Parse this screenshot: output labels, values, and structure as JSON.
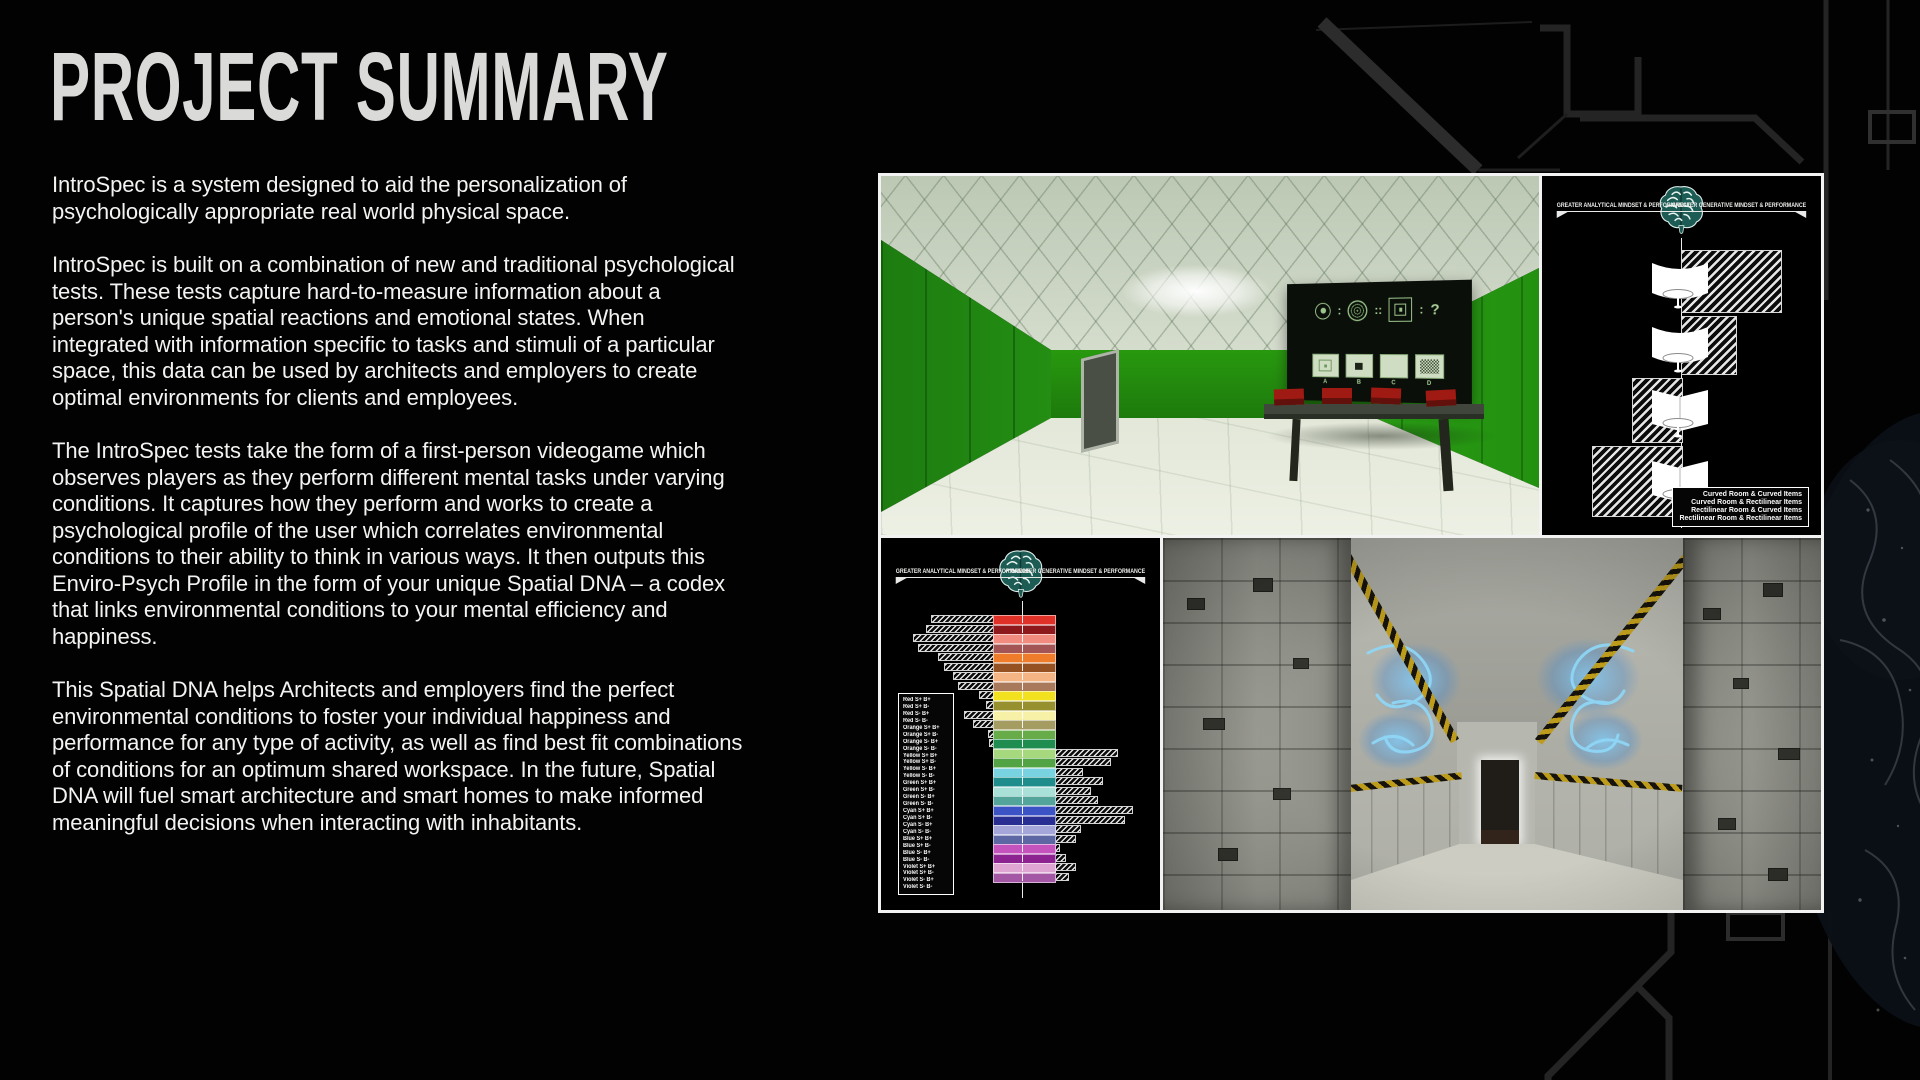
{
  "palette": {
    "background": "#020202",
    "text": "#f3f3f1",
    "panel_border": "#f2f2f2",
    "chroma_green": "#2aa216",
    "brain_teal": "#1d5b55",
    "hazard_yellow": "#bd9c1c",
    "glow_blue": "#78c8fa",
    "hatch_white": "#e6e6e6"
  },
  "header": {
    "title": "PROJECT SUMMARY"
  },
  "summary": {
    "paragraphs": [
      "IntroSpec is a system designed to aid the personalization of psychologically appropriate real world physical space.",
      "IntroSpec is built on a combination of new and traditional psychological tests. These tests capture hard-to-measure information about a person's unique spatial reactions and emotional states. When integrated with information specific to tasks and stimuli of a particular space, this data can be used by architects and employers to create optimal environments for clients and employees.",
      "The IntroSpec tests take the form of a first-person videogame which observes players as they perform different mental tasks under varying conditions. It captures how they perform and works to create a psychological profile of the user which correlates environmental conditions to their ability to think in various ways. It then outputs this Enviro-Psych Profile in the form of your unique Spatial DNA – a codex that links environmental conditions to your mental efficiency and happiness.",
      "This Spatial DNA helps Architects and employers find the perfect environmental conditions to foster your individual happiness and performance for any type of activity, as well as find best fit combinations of conditions for an optimum shared workspace. In the future, Spatial DNA will fuel smart architecture and smart homes to make informed meaningful decisions when interacting with inhabitants."
    ]
  },
  "mindset_axis": {
    "left_label": "GREATER ANALYTICAL MINDSET & PERFORMANCE",
    "right_label": "GREATER GENERATIVE MINDSET & PERFORMANCE"
  },
  "room_preference_diagram": {
    "rows": [
      {
        "room": "curved",
        "items": "curved",
        "side": "right",
        "length": 99
      },
      {
        "room": "curved",
        "items": "rectilinear",
        "side": "right",
        "length": 54
      },
      {
        "room": "rectilinear",
        "items": "curved",
        "side": "left",
        "length": 49
      },
      {
        "room": "rectilinear",
        "items": "rectilinear",
        "side": "left",
        "length": 89
      }
    ],
    "legend": [
      "Curved Room & Curved Items",
      "Curved Room & Rectilinear Items",
      "Rectilinear Room & Curved Items",
      "Rectilinear Room & Rectilinear Items"
    ]
  },
  "green_room_puzzle": {
    "separator_single": ":",
    "separator_double": "::",
    "question_mark": "?",
    "options": [
      "A",
      "B",
      "C",
      "D"
    ]
  },
  "chart_data": {
    "type": "bar",
    "orientation": "diverging-horizontal",
    "axis_left_label": "GREATER ANALYTICAL MINDSET & PERFORMANCE",
    "axis_right_label": "GREATER GENERATIVE MINDSET & PERFORMANCE",
    "xlim": [
      -100,
      100
    ],
    "grid": false,
    "legend_position": "left",
    "categories": [
      "Red S+ B+",
      "Red S+ B-",
      "Red S- B+",
      "Red S- B-",
      "Orange S+ B+",
      "Orange S+ B-",
      "Orange S- B+",
      "Orange S- B-",
      "Yellow S+ B+",
      "Yellow S+ B-",
      "Yellow S- B+",
      "Yellow S- B-",
      "Green S+ B+",
      "Green S+ B-",
      "Green S- B+",
      "Green S- B-",
      "Cyan S+ B+",
      "Cyan S+ B-",
      "Cyan S- B+",
      "Cyan S- B-",
      "Blue S+ B+",
      "Blue S+ B-",
      "Blue S- B+",
      "Blue S- B-",
      "Violet S+ B+",
      "Violet S+ B-",
      "Violet S- B+",
      "Violet S- B-"
    ],
    "values": [
      -62,
      -67,
      -80,
      -75,
      -55,
      -49,
      -40,
      -35,
      -14,
      -7,
      -29,
      -20,
      -5,
      -4,
      62,
      55,
      27,
      47,
      35,
      42,
      77,
      69,
      25,
      20,
      4,
      10,
      20,
      13
    ],
    "colors": [
      "#e03128",
      "#8e191c",
      "#f18a7f",
      "#a35454",
      "#ef7c2b",
      "#955122",
      "#f4b483",
      "#a87a5b",
      "#f1e11f",
      "#97902e",
      "#f6f1a6",
      "#a49c60",
      "#67ac48",
      "#1f8d50",
      "#a6d87e",
      "#52a344",
      "#78d2df",
      "#1f8d8b",
      "#a9e1d9",
      "#53a49a",
      "#3c53c5",
      "#292e92",
      "#a4a6da",
      "#5d67a4",
      "#c553be",
      "#8d2291",
      "#dfa6d4",
      "#a457a4"
    ]
  }
}
